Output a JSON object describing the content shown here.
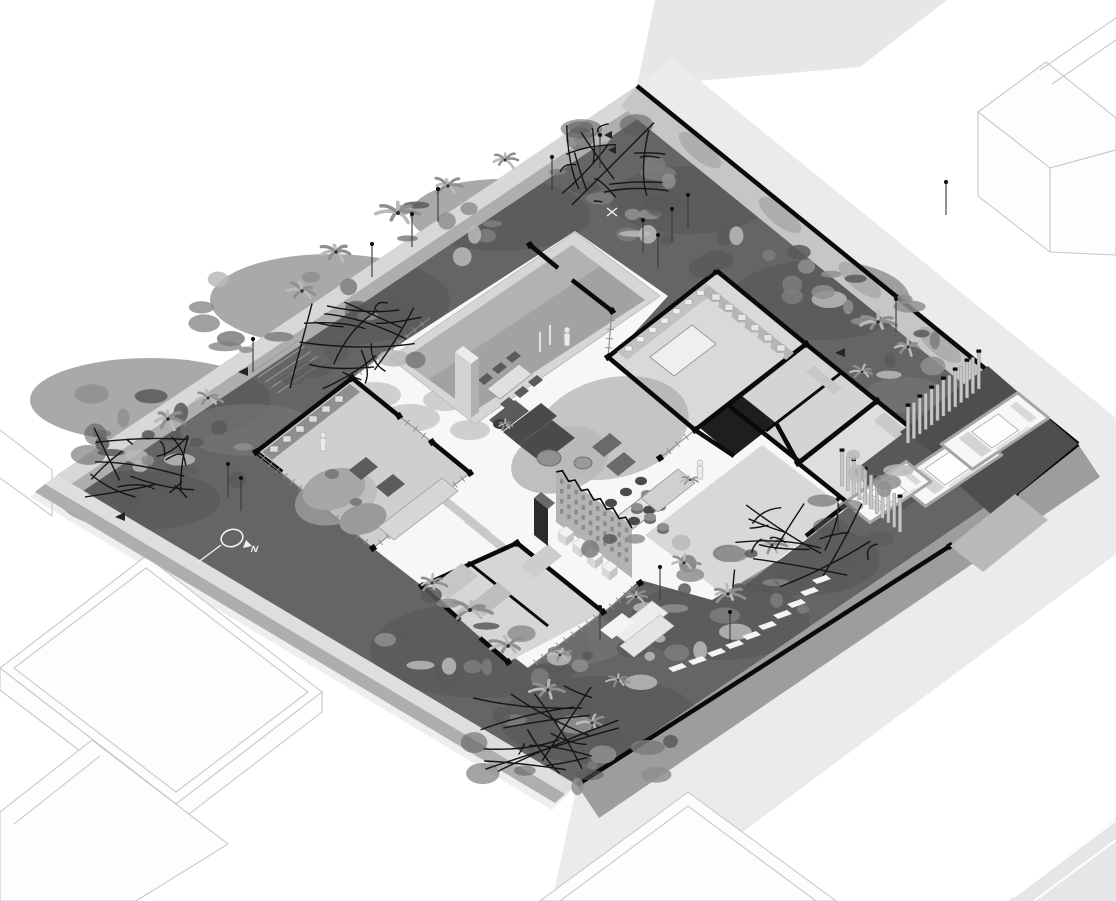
{
  "title": "Axonometric cutaway site plan of a walled single-storey house",
  "compass": {
    "label": "N"
  },
  "colors": {
    "background": "#ffffff",
    "street": "#ebebeb",
    "street_top": "#e7e7e7",
    "road": "#e6e6e6",
    "neighbor_fill": "#fdfdfd",
    "neighbor_stroke": "#c8c8c8",
    "ground": "#656565",
    "ground_dark": "#535353",
    "ground_light": "#7c7c7c",
    "wall_cut": "#0a0a0a",
    "wall_light": "#d8d8d8",
    "wall_mid": "#aeaeae",
    "wall_face": "#9d9d9d",
    "wall_inner": "#c6c6c6",
    "deck": "#f7f7f7",
    "deck_shadow": "#c8c8c8",
    "canopy_shade": "#a3a3a3",
    "pool_rim": "#d6d6d6",
    "water": "#a2a2a2",
    "water_light": "#c0c0c0",
    "room_floor": "#d7d7d7",
    "furniture_dark": "#4a4a4a",
    "furniture_mid": "#8f8f8f",
    "furniture_light": "#e9e9e9",
    "screen": "#b3b3b3",
    "slat": "#c6c6c6",
    "garage_floor": "#4e4e4e",
    "driveway": "#b9b9b9",
    "car_body": "#f7f7f7",
    "car_line": "#a5a5a5",
    "car_glass": "#d4d4d4",
    "foliage": "#8f8f8f",
    "foliage_dark": "#595959",
    "foliage_light": "#bababa",
    "branch": "#141414",
    "person": "#ebebeb",
    "marker": "#f0f0f0"
  },
  "scene": {
    "kind": "isometric-architectural-rendering",
    "site": "walled residential corner lot with tropical garden",
    "elements": [
      "boundary-walls",
      "swimming-pool",
      "pool-ladder",
      "sun-loungers",
      "outdoor-dining-set",
      "kitchen-island",
      "wall-shelving",
      "living-sofa",
      "round-rug",
      "coffee-tables",
      "armchairs",
      "indoor-dining-table",
      "bar-counter-with-stools",
      "perforated-screen-wall",
      "bench-seats",
      "lounge-room",
      "bathroom-block",
      "utility-rooms",
      "dark-storage-room",
      "suite-room",
      "garage",
      "cars",
      "louver-slat-screens",
      "driveway",
      "stepping-stone-path",
      "entry-steps",
      "palm-plants",
      "bare-branch-trees",
      "garden-light-posts",
      "people-figures",
      "north-arrow",
      "neighboring-buildings",
      "streets-and-sidewalks"
    ],
    "counts": {
      "cars": 3,
      "people": 3,
      "sun_loungers": 5,
      "bench_seats": 4
    }
  }
}
